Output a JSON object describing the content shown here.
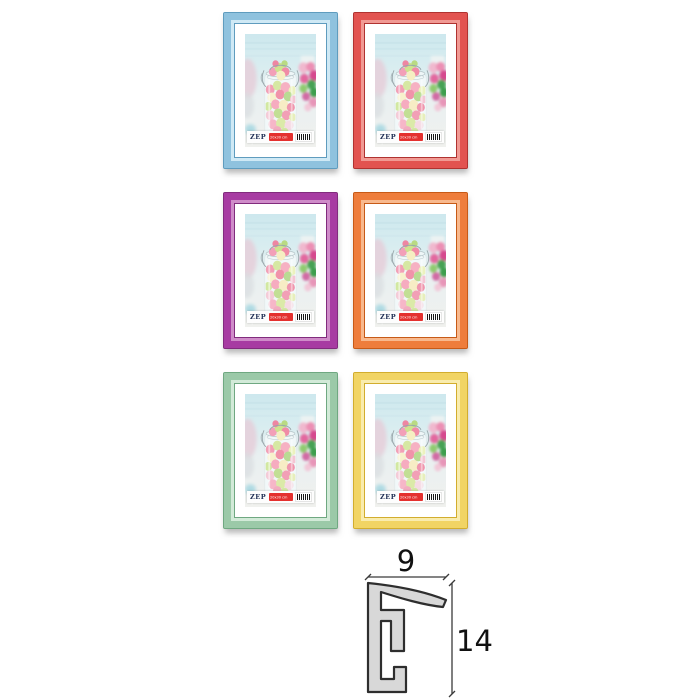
{
  "page": {
    "background": "#ffffff"
  },
  "product_label": {
    "brand": "ZEP",
    "size_text": "20x30 cm"
  },
  "frames": [
    {
      "name": "blue",
      "main": "#8fc2de",
      "light": "#cfe9f5",
      "dark": "#5f9cbe"
    },
    {
      "name": "red",
      "main": "#e25350",
      "light": "#f19a94",
      "dark": "#b03230"
    },
    {
      "name": "purple",
      "main": "#a73ba2",
      "light": "#cf8cc9",
      "dark": "#812b7d"
    },
    {
      "name": "orange",
      "main": "#ee7d3c",
      "light": "#f8b98e",
      "dark": "#c75a17"
    },
    {
      "name": "green",
      "main": "#9bc9a8",
      "light": "#d2ead8",
      "dark": "#6fa881"
    },
    {
      "name": "yellow",
      "main": "#f1d464",
      "light": "#f9ecae",
      "dark": "#d2ad2e"
    }
  ],
  "diagram": {
    "width_label": "9",
    "height_label": "14",
    "profile_fill": "#d8d8d8",
    "profile_stroke": "#2e2e2e"
  }
}
